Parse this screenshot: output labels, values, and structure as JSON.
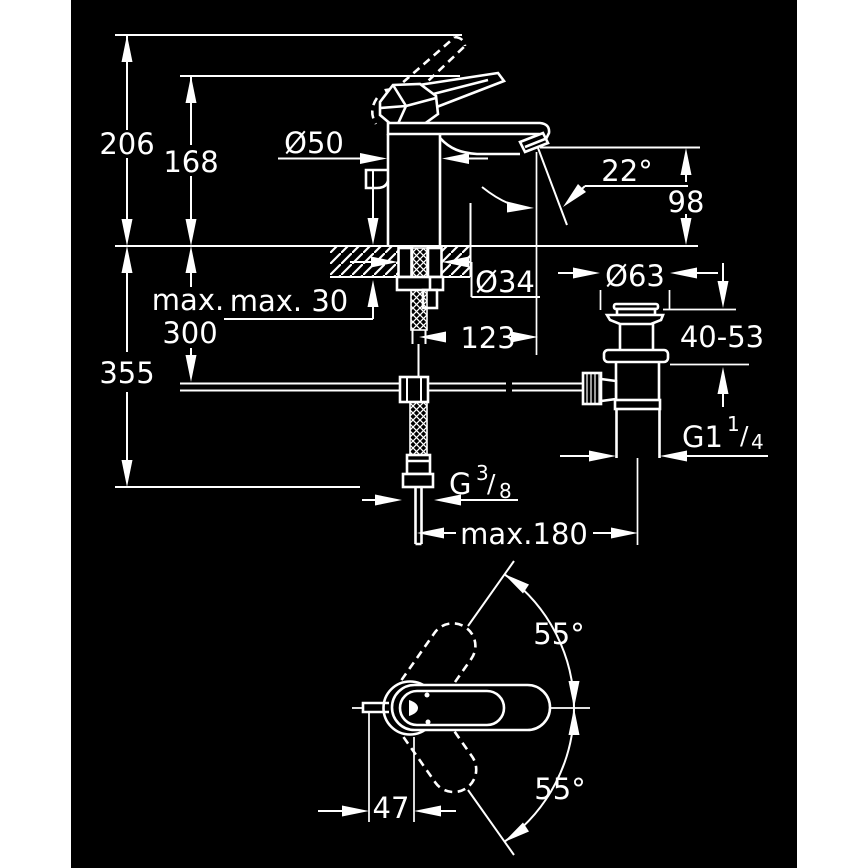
{
  "canvas": {
    "background": "#ffffff",
    "panel_color": "#000000",
    "stroke_color": "#ffffff"
  },
  "side_view": {
    "total_height": "206",
    "spout_height": "168",
    "body_diameter": "Ø50",
    "aerator_angle": "22°",
    "spout_drop": "98",
    "hole_diameter": "Ø34",
    "deck_thickness_max": "max. 30",
    "hose_length_word": "max.",
    "hose_length_value": "300",
    "install_depth": "355",
    "spout_reach": "123",
    "reach_max": "max.180",
    "supply_thread": {
      "base": "G",
      "sup": "3",
      "slash": "/",
      "sub": "8"
    }
  },
  "waste_view": {
    "flange_diameter": "Ø63",
    "clamp_range": "40-53",
    "thread": {
      "base": "G1",
      "sup": "1",
      "slash": "/",
      "sub": "4"
    }
  },
  "top_view": {
    "swing_upper": "55°",
    "swing_lower": "55°",
    "pivot_offset": "47"
  }
}
